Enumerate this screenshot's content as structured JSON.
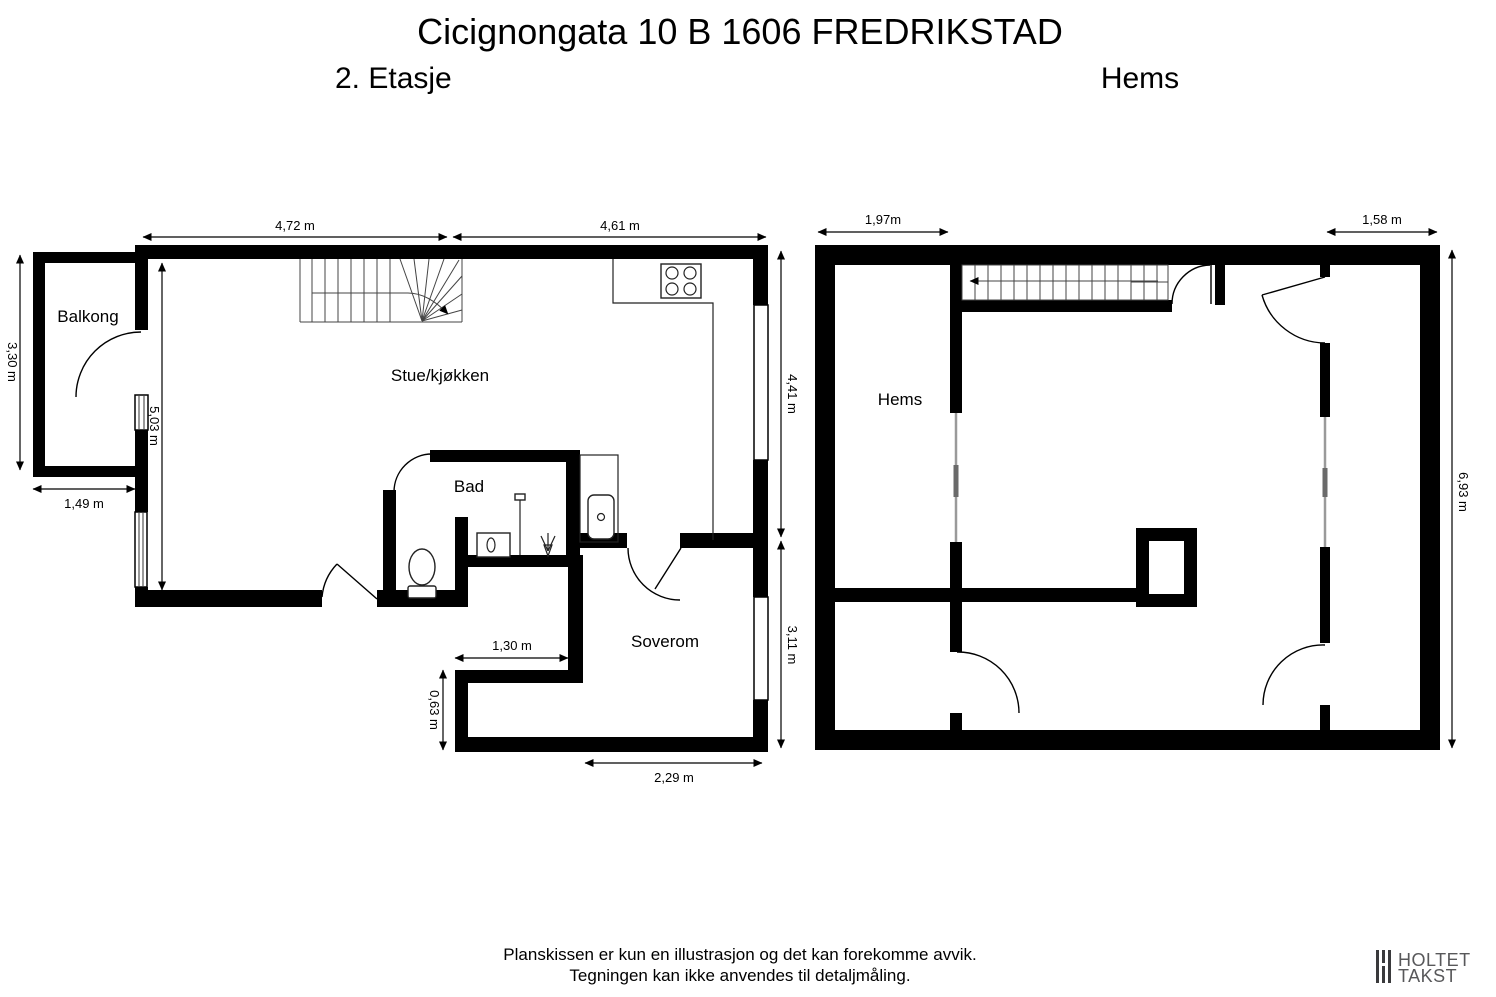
{
  "header": {
    "title": "Cicignongata 10 B 1606 FREDRIKSTAD",
    "floor_left_label": "2. Etasje",
    "floor_right_label": "Hems"
  },
  "plan2": {
    "rooms": {
      "balkong": "Balkong",
      "stue": "Stue/kjøkken",
      "bad": "Bad",
      "soverom": "Soverom"
    },
    "dims": {
      "top_left": "4,72 m",
      "top_right": "4,61 m",
      "balkong_height": "3,30 m",
      "balkong_width": "1,49 m",
      "stue_height": "5,03 m",
      "right_upper": "4,41 m",
      "right_lower": "3,11 m",
      "corridor_width": "1,30 m",
      "nook_height": "0,63 m",
      "bottom_width": "2,29 m"
    }
  },
  "hems": {
    "rooms": {
      "hems": "Hems"
    },
    "dims": {
      "top_left": "1,97m",
      "top_right": "1,58 m",
      "right": "6,93 m"
    }
  },
  "footer": {
    "disclaimer_line1": "Planskissen er kun en illustrasjon og det kan forekomme avvik.",
    "disclaimer_line2": "Tegningen kan ikke anvendes til detaljmåling.",
    "logo_line1": "HOLTET",
    "logo_line2": "TAKST"
  },
  "colors": {
    "wall": "#000000",
    "logo_gray": "#58585a",
    "background": "#ffffff"
  }
}
